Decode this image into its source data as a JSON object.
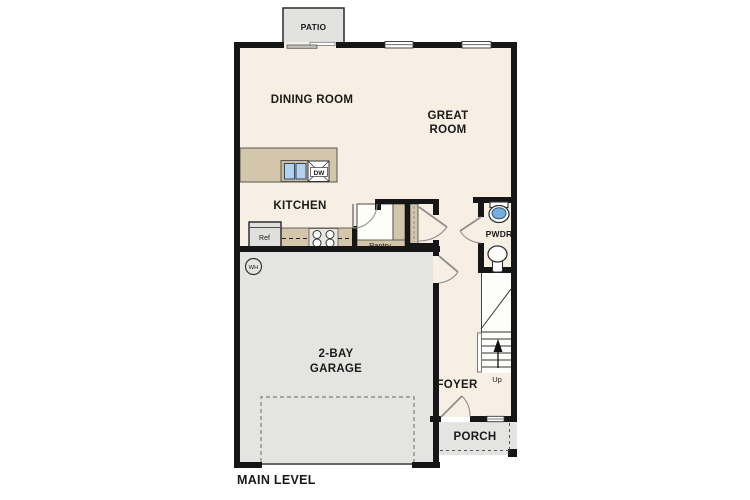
{
  "title": "MAIN LEVEL",
  "colors": {
    "floor_cream": "#f7efe3",
    "garage_gray": "#e4e4e2",
    "patio_gray": "#e2e2e0",
    "porch_gray": "#e4e4e2",
    "counter_tan": "#d4c6aa",
    "sink_blue": "#b4d2ee",
    "toilet_blue": "#77aede",
    "wall_black": "#161616",
    "door_gray": "#8f8f8f"
  },
  "rooms": {
    "patio": "PATIO",
    "dining": "DINING ROOM",
    "great_line1": "GREAT",
    "great_line2": "ROOM",
    "kitchen": "KITCHEN",
    "pantry": "Pantry",
    "pwdr": "PWDR",
    "foyer": "FOYER",
    "garage_line1": "2-BAY",
    "garage_line2": "GARAGE",
    "porch": "PORCH"
  },
  "fixtures": {
    "refrigerator": "Ref",
    "dishwasher": "DW",
    "water_heater": "WH",
    "stairs_direction": "Up"
  }
}
